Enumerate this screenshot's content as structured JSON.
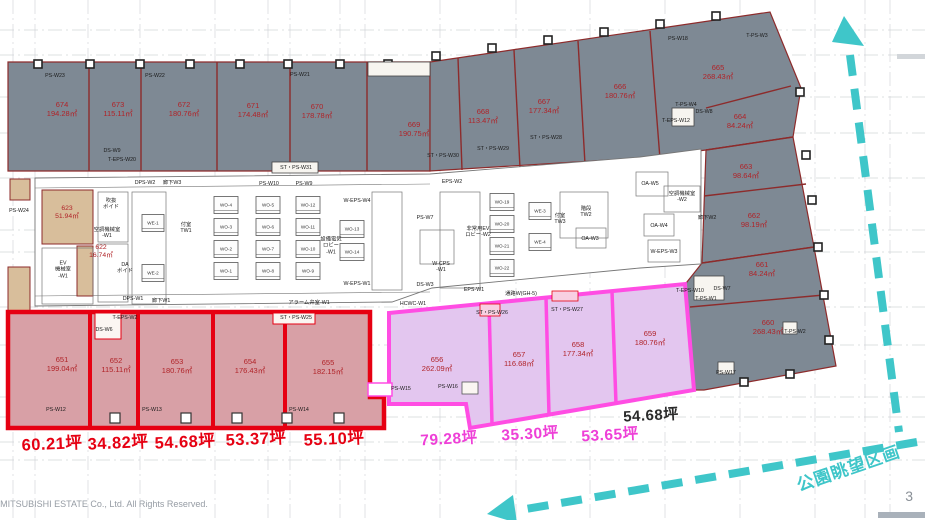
{
  "page": {
    "number": "3",
    "copyright": "ight © MITSUBISHI ESTATE Co., Ltd. All Rights Reserved."
  },
  "legend": {
    "park_view": "公園眺望区画"
  },
  "colors": {
    "gray_fill": "#7e8994",
    "gray_line": "#8d2b2b",
    "red_fill": "#d8a0a6",
    "red_border": "#e60012",
    "red_text": "#b02328",
    "magenta_fill": "#e3c6ef",
    "magenta_border": "#ff4de3",
    "magenta_text": "#ee3fd7",
    "tan_fill": "#d8be9b",
    "cyan": "#3fc6c9",
    "black_text": "#2b2b2b",
    "core_line": "#777777",
    "grid_line": "#c9ccd0"
  },
  "rooms": {
    "gray": [
      {
        "id": "674",
        "area": "194.28㎡",
        "x": 62,
        "y": 110
      },
      {
        "id": "673",
        "area": "115.11㎡",
        "x": 118,
        "y": 110
      },
      {
        "id": "672",
        "area": "180.76㎡",
        "x": 184,
        "y": 110
      },
      {
        "id": "671",
        "area": "174.48㎡",
        "x": 253,
        "y": 111
      },
      {
        "id": "670",
        "area": "178.78㎡",
        "x": 317,
        "y": 112
      },
      {
        "id": "669",
        "area": "190.75㎡",
        "x": 414,
        "y": 130
      },
      {
        "id": "668",
        "area": "113.47㎡",
        "x": 483,
        "y": 117
      },
      {
        "id": "667",
        "area": "177.34㎡",
        "x": 544,
        "y": 107
      },
      {
        "id": "666",
        "area": "180.76㎡",
        "x": 620,
        "y": 92
      },
      {
        "id": "665",
        "area": "268.43㎡",
        "x": 718,
        "y": 73
      },
      {
        "id": "664",
        "area": "84.24㎡",
        "x": 740,
        "y": 122
      },
      {
        "id": "663",
        "area": "98.64㎡",
        "x": 746,
        "y": 172
      },
      {
        "id": "662",
        "area": "98.19㎡",
        "x": 754,
        "y": 221
      },
      {
        "id": "661",
        "area": "84.24㎡",
        "x": 762,
        "y": 270
      },
      {
        "id": "660",
        "area": "268.43㎡",
        "x": 768,
        "y": 328
      }
    ],
    "red": [
      {
        "id": "651",
        "area": "199.04㎡",
        "x": 62,
        "y": 365
      },
      {
        "id": "652",
        "area": "115.11㎡",
        "x": 116,
        "y": 366
      },
      {
        "id": "653",
        "area": "180.76㎡",
        "x": 177,
        "y": 367
      },
      {
        "id": "654",
        "area": "176.43㎡",
        "x": 250,
        "y": 367
      },
      {
        "id": "655",
        "area": "182.15㎡",
        "x": 328,
        "y": 368
      }
    ],
    "magenta": [
      {
        "id": "656",
        "area": "262.09㎡",
        "x": 437,
        "y": 365
      },
      {
        "id": "657",
        "area": "116.68㎡",
        "x": 519,
        "y": 360
      },
      {
        "id": "658",
        "area": "177.34㎡",
        "x": 578,
        "y": 350
      },
      {
        "id": "659",
        "area": "180.76㎡",
        "x": 650,
        "y": 339
      }
    ],
    "tan": [
      {
        "id": "623",
        "area": "51.94㎡",
        "x": 67,
        "y": 213
      },
      {
        "id": "622",
        "area": "16.74㎡",
        "x": 101,
        "y": 252
      }
    ]
  },
  "tsubo": {
    "red": [
      {
        "text": "60.21坪",
        "x": 52,
        "y": 445
      },
      {
        "text": "34.82坪",
        "x": 118,
        "y": 444
      },
      {
        "text": "54.68坪",
        "x": 185,
        "y": 443
      },
      {
        "text": "53.37坪",
        "x": 256,
        "y": 440
      },
      {
        "text": "55.10坪",
        "x": 334,
        "y": 440
      }
    ],
    "magenta": [
      {
        "text": "79.28坪",
        "x": 449,
        "y": 440
      },
      {
        "text": "35.30坪",
        "x": 530,
        "y": 435
      },
      {
        "text": "53.65坪",
        "x": 610,
        "y": 436
      }
    ],
    "black": [
      {
        "text": "54.68坪",
        "x": 651,
        "y": 416
      }
    ]
  },
  "service_labels": [
    {
      "text": "PS-W23",
      "x": 55,
      "y": 76
    },
    {
      "text": "PS-W22",
      "x": 155,
      "y": 76
    },
    {
      "text": "PS-W21",
      "x": 300,
      "y": 75
    },
    {
      "text": "PS-W18",
      "x": 678,
      "y": 39
    },
    {
      "text": "T-PS-W3",
      "x": 757,
      "y": 36
    },
    {
      "text": "DS-W9",
      "x": 112,
      "y": 151
    },
    {
      "text": "T-EPS-W20",
      "x": 122,
      "y": 160
    },
    {
      "text": "ST・PS-W31",
      "x": 296,
      "y": 168
    },
    {
      "text": "ST・PS-W30",
      "x": 443,
      "y": 156
    },
    {
      "text": "ST・PS-W29",
      "x": 493,
      "y": 149
    },
    {
      "text": "ST・PS-W28",
      "x": 546,
      "y": 138
    },
    {
      "text": "T-EPS-W12",
      "x": 676,
      "y": 121
    },
    {
      "text": "T-PS-W4",
      "x": 686,
      "y": 105
    },
    {
      "text": "DS-W8",
      "x": 704,
      "y": 112
    },
    {
      "text": "T-EPS-W10",
      "x": 690,
      "y": 291
    },
    {
      "text": "T-PS-W1",
      "x": 706,
      "y": 299
    },
    {
      "text": "DS-W7",
      "x": 722,
      "y": 289
    },
    {
      "text": "T-PS-W2",
      "x": 795,
      "y": 332
    },
    {
      "text": "PS-W17",
      "x": 726,
      "y": 373
    },
    {
      "text": "PS-W24",
      "x": 19,
      "y": 211
    },
    {
      "text": "T-EPS-W2",
      "x": 125,
      "y": 318
    },
    {
      "text": "DS-W6",
      "x": 104,
      "y": 330
    },
    {
      "text": "ST・PS-W25",
      "x": 296,
      "y": 318
    },
    {
      "text": "PS-W12",
      "x": 56,
      "y": 410
    },
    {
      "text": "PS-W13",
      "x": 152,
      "y": 410
    },
    {
      "text": "PS-W14",
      "x": 299,
      "y": 410
    },
    {
      "text": "PS-W15",
      "x": 401,
      "y": 389
    },
    {
      "text": "PS-W16",
      "x": 448,
      "y": 387
    },
    {
      "text": "ST・PS-W26",
      "x": 492,
      "y": 313
    },
    {
      "text": "ST・PS-W27",
      "x": 567,
      "y": 310
    },
    {
      "text": "廊下W2",
      "x": 707,
      "y": 218
    }
  ],
  "core_labels": [
    {
      "text": "吹抜\nボイド",
      "x": 111,
      "y": 204
    },
    {
      "text": "空調機械室\n-W1",
      "x": 107,
      "y": 233
    },
    {
      "text": "EV\n機械室\n-W1",
      "x": 63,
      "y": 270
    },
    {
      "text": "DA\nボイド",
      "x": 125,
      "y": 268
    },
    {
      "text": "付室\nTW1",
      "x": 186,
      "y": 228
    },
    {
      "text": "DPS-W2",
      "x": 145,
      "y": 183
    },
    {
      "text": "廊下W3",
      "x": 172,
      "y": 183
    },
    {
      "text": "DPS-W1",
      "x": 133,
      "y": 299
    },
    {
      "text": "廊下W1",
      "x": 161,
      "y": 301
    },
    {
      "text": "設備電気\nロビー\n-W1",
      "x": 331,
      "y": 246
    },
    {
      "text": "W-EPS-W4",
      "x": 357,
      "y": 201
    },
    {
      "text": "W-EPS-W1",
      "x": 357,
      "y": 284
    },
    {
      "text": "PS-W10",
      "x": 269,
      "y": 184
    },
    {
      "text": "PS-W9",
      "x": 304,
      "y": 184
    },
    {
      "text": "PS-W7",
      "x": 425,
      "y": 218
    },
    {
      "text": "EPS-W2",
      "x": 452,
      "y": 182
    },
    {
      "text": "W-CPS\n-W1",
      "x": 441,
      "y": 267
    },
    {
      "text": "DS-W3",
      "x": 425,
      "y": 285
    },
    {
      "text": "HCWC-W1",
      "x": 413,
      "y": 304
    },
    {
      "text": "アラーム弁室-W1",
      "x": 309,
      "y": 303
    },
    {
      "text": "非常用EV\nロビー-W2",
      "x": 478,
      "y": 232
    },
    {
      "text": "付室\nTW3",
      "x": 560,
      "y": 219
    },
    {
      "text": "階段\nTW2",
      "x": 586,
      "y": 212
    },
    {
      "text": "OA-W5",
      "x": 650,
      "y": 184
    },
    {
      "text": "OA-W4",
      "x": 659,
      "y": 226
    },
    {
      "text": "OA-W3",
      "x": 590,
      "y": 239
    },
    {
      "text": "空調機械室\n-W2",
      "x": 682,
      "y": 197
    },
    {
      "text": "W-EPS-W3",
      "x": 664,
      "y": 252
    },
    {
      "text": "通路W(GH-5)",
      "x": 521,
      "y": 294
    },
    {
      "text": "EPS-W1",
      "x": 474,
      "y": 290
    }
  ],
  "shafts": [
    {
      "label": "WO-4",
      "x": 226,
      "y": 205
    },
    {
      "label": "WO-3",
      "x": 226,
      "y": 227
    },
    {
      "label": "WO-2",
      "x": 226,
      "y": 249
    },
    {
      "label": "WO-1",
      "x": 226,
      "y": 271
    },
    {
      "label": "WO-5",
      "x": 268,
      "y": 205
    },
    {
      "label": "WO-6",
      "x": 268,
      "y": 227
    },
    {
      "label": "WO-7",
      "x": 268,
      "y": 249
    },
    {
      "label": "WO-8",
      "x": 268,
      "y": 271
    },
    {
      "label": "WO-12",
      "x": 308,
      "y": 205
    },
    {
      "label": "WO-11",
      "x": 308,
      "y": 227
    },
    {
      "label": "WO-10",
      "x": 308,
      "y": 249
    },
    {
      "label": "WO-9",
      "x": 308,
      "y": 271
    },
    {
      "label": "WO-13",
      "x": 352,
      "y": 229
    },
    {
      "label": "WO-14",
      "x": 352,
      "y": 252
    },
    {
      "label": "WO-19",
      "x": 502,
      "y": 202
    },
    {
      "label": "WO-20",
      "x": 502,
      "y": 224
    },
    {
      "label": "WO-21",
      "x": 502,
      "y": 246
    },
    {
      "label": "WO-22",
      "x": 502,
      "y": 268
    },
    {
      "label": "WE-1",
      "x": 153,
      "y": 223
    },
    {
      "label": "WE-2",
      "x": 153,
      "y": 273
    },
    {
      "label": "WE-3",
      "x": 540,
      "y": 211
    },
    {
      "label": "WE-4",
      "x": 540,
      "y": 242
    }
  ]
}
